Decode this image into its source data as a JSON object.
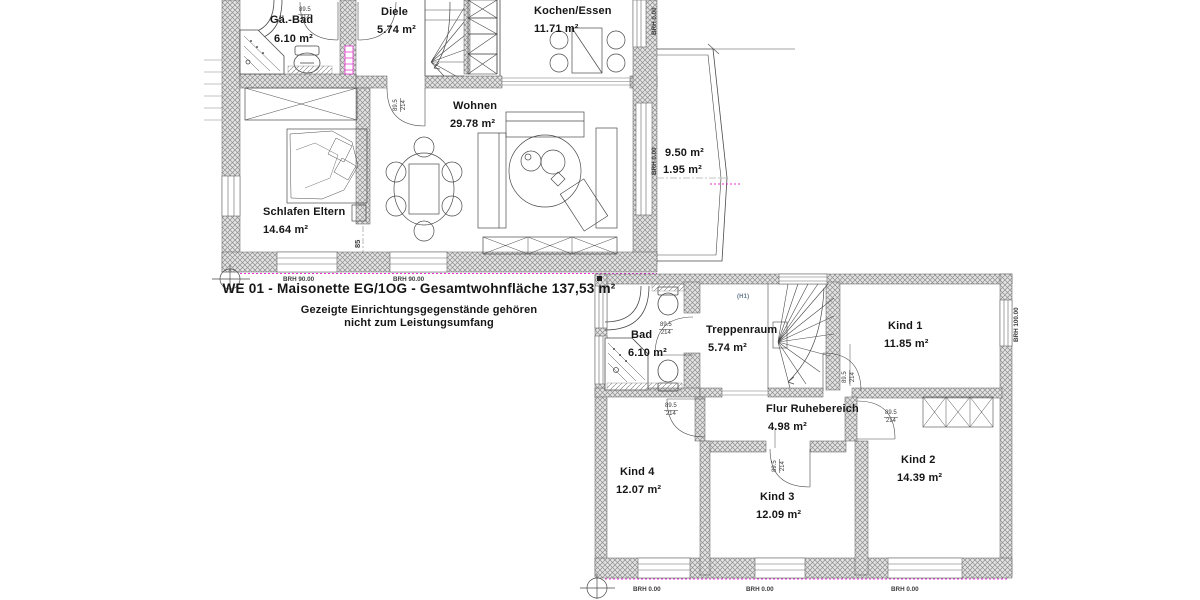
{
  "plan": {
    "title": "WE 01 - Maisonette EG/1OG - Gesamtwohnfläche 137,53 m²",
    "note_line1": "Gezeigte Einrichtungsgegenstände gehören",
    "note_line2": "nicht zum Leistungsumfang"
  },
  "eg": {
    "rooms": {
      "gaebad": {
        "name": "Gä.-Bad",
        "area": "6.10 m²"
      },
      "diele": {
        "name": "Diele",
        "area": "5.74 m²"
      },
      "kochen": {
        "name": "Kochen/Essen",
        "area": "11.71 m²"
      },
      "wohnen": {
        "name": "Wohnen",
        "area": "29.78 m²"
      },
      "schlafen": {
        "name": "Schlafen Eltern",
        "area": "14.64 m²"
      }
    },
    "balcony": {
      "area_upper": "9.50 m²",
      "area_lower": "1.95 m²"
    },
    "sill_labels": {
      "bottom_1": "BRH 90.00",
      "bottom_2": "BRH 90.00",
      "right_1": "BRH 0.00",
      "right_2": "BRH 0.00"
    },
    "opening_width": "85"
  },
  "og": {
    "rooms": {
      "bad": {
        "name": "Bad",
        "area": "6.10 m²"
      },
      "trepp": {
        "name": "Treppenraum",
        "area": "5.74 m²"
      },
      "kind1": {
        "name": "Kind 1",
        "area": "11.85 m²"
      },
      "flur": {
        "name": "Flur Ruhebereich",
        "area": "4.98 m²"
      },
      "kind4": {
        "name": "Kind 4",
        "area": "12.07 m²"
      },
      "kind3": {
        "name": "Kind 3",
        "area": "12.09 m²"
      },
      "kind2": {
        "name": "Kind 2",
        "area": "14.39 m²"
      }
    },
    "stair_ref": "(H1)",
    "sill_labels": {
      "bottom_1": "BRH 0.00",
      "bottom_2": "BRH 0.00",
      "bottom_3": "BRH 0.00",
      "right_1": "BRH 100.00"
    }
  },
  "door_dims": {
    "width": "89.5",
    "height": "214"
  },
  "colors": {
    "line": "#4a4a4a",
    "wall_fill": "#e3e3e3",
    "accent_magenta": "#e631cf"
  }
}
